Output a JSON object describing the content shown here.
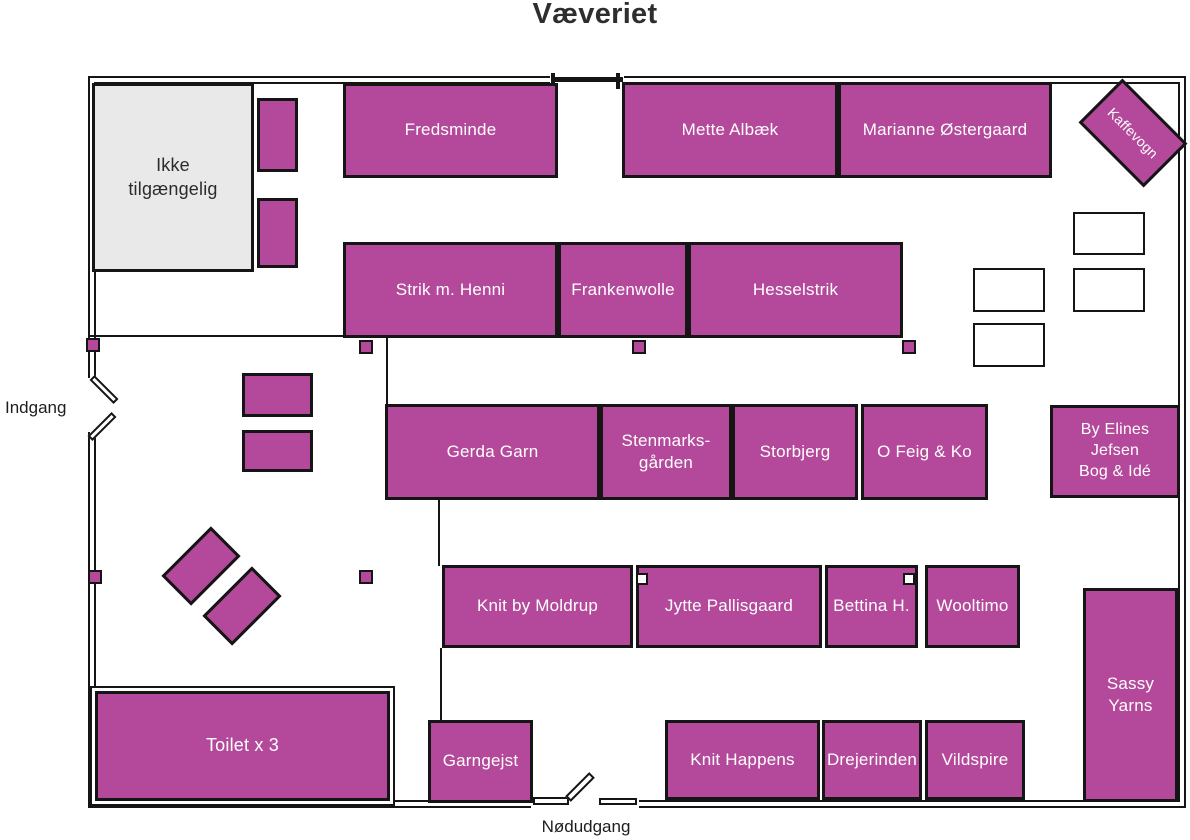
{
  "title": "Væveriet",
  "labels": {
    "entrance": "Indgang",
    "emergency_exit": "Nødudgang"
  },
  "colors": {
    "booth_fill": "#b4499b",
    "outline": "#151515",
    "unavailable_fill": "#e9e9e9",
    "booth_text": "#ffffff",
    "title_text": "#2e2e2e"
  },
  "floorplan": {
    "booths": [
      {
        "name": "ikke-tilgaengelig",
        "label": "Ikke\ntilgængelig",
        "type": "unavailable",
        "x": 92,
        "y": 83,
        "w": 162,
        "h": 189,
        "font": 18
      },
      {
        "name": "stand-top-1",
        "label": "",
        "x": 257,
        "y": 98,
        "w": 41,
        "h": 74
      },
      {
        "name": "stand-top-2",
        "label": "",
        "x": 257,
        "y": 198,
        "w": 41,
        "h": 70
      },
      {
        "name": "fredsminde",
        "label": "Fredsminde",
        "x": 343,
        "y": 83,
        "w": 215,
        "h": 95
      },
      {
        "name": "mette-albaek",
        "label": "Mette Albæk",
        "x": 622,
        "y": 82,
        "w": 216,
        "h": 96
      },
      {
        "name": "marianne-oestergaard",
        "label": "Marianne Østergaard",
        "x": 838,
        "y": 82,
        "w": 214,
        "h": 96
      },
      {
        "name": "kaffevogn",
        "label": "Kaffevogn",
        "x": 1087,
        "y": 102,
        "w": 92,
        "h": 62,
        "rotate": 45,
        "font": 14
      },
      {
        "name": "strik-m-henni",
        "label": "Strik m. Henni",
        "x": 343,
        "y": 242,
        "w": 215,
        "h": 96
      },
      {
        "name": "frankenwolle",
        "label": "Frankenwolle",
        "x": 558,
        "y": 242,
        "w": 130,
        "h": 96
      },
      {
        "name": "hesselstrik",
        "label": "Hesselstrik",
        "x": 688,
        "y": 242,
        "w": 215,
        "h": 96
      },
      {
        "name": "gerda-garn",
        "label": "Gerda Garn",
        "x": 385,
        "y": 404,
        "w": 215,
        "h": 96
      },
      {
        "name": "stenmarksgaarden",
        "label": "Stenmarks-\ngården",
        "x": 600,
        "y": 404,
        "w": 132,
        "h": 96
      },
      {
        "name": "storbjerg",
        "label": "Storbjerg",
        "x": 732,
        "y": 404,
        "w": 126,
        "h": 96
      },
      {
        "name": "o-feig-og-ko",
        "label": "O Feig & Ko",
        "x": 861,
        "y": 404,
        "w": 127,
        "h": 96
      },
      {
        "name": "by-elines-jefsen",
        "label": "By Elines\nJefsen\nBog & Idé",
        "x": 1050,
        "y": 405,
        "w": 130,
        "h": 93,
        "font": 16
      },
      {
        "name": "knit-by-moldrup",
        "label": "Knit by Moldrup",
        "x": 442,
        "y": 565,
        "w": 191,
        "h": 83
      },
      {
        "name": "jytte-pallisgaard",
        "label": "Jytte Pallisgaard",
        "x": 636,
        "y": 565,
        "w": 186,
        "h": 83
      },
      {
        "name": "bettina-h",
        "label": "Bettina H.",
        "x": 825,
        "y": 565,
        "w": 93,
        "h": 83
      },
      {
        "name": "wooltimo",
        "label": "Wooltimo",
        "x": 925,
        "y": 565,
        "w": 95,
        "h": 83
      },
      {
        "name": "sassy-yarns",
        "label": "Sassy\nYarns",
        "x": 1083,
        "y": 588,
        "w": 95,
        "h": 214
      },
      {
        "name": "toilet",
        "label": "Toilet x 3",
        "type": "toilet",
        "x": 95,
        "y": 691,
        "w": 295,
        "h": 110,
        "font": 18
      },
      {
        "name": "garngejst",
        "label": "Garngejst",
        "x": 428,
        "y": 720,
        "w": 105,
        "h": 83
      },
      {
        "name": "knit-happens",
        "label": "Knit Happens",
        "x": 665,
        "y": 720,
        "w": 155,
        "h": 80
      },
      {
        "name": "drejerinden",
        "label": "Drejerinden",
        "x": 822,
        "y": 720,
        "w": 100,
        "h": 80
      },
      {
        "name": "vildspire",
        "label": "Vildspire",
        "x": 925,
        "y": 720,
        "w": 100,
        "h": 80
      },
      {
        "name": "table-diagonal-1",
        "label": "",
        "x": 166,
        "y": 545,
        "w": 70,
        "h": 42,
        "rotate": -45
      },
      {
        "name": "table-diagonal-2",
        "label": "",
        "x": 207,
        "y": 585,
        "w": 70,
        "h": 42,
        "rotate": -45
      },
      {
        "name": "stand-left-1",
        "label": "",
        "x": 242,
        "y": 373,
        "w": 71,
        "h": 44
      },
      {
        "name": "stand-left-2",
        "label": "",
        "x": 242,
        "y": 430,
        "w": 71,
        "h": 42
      }
    ],
    "storage_boxes": [
      {
        "x": 1073,
        "y": 212,
        "w": 72,
        "h": 43
      },
      {
        "x": 973,
        "y": 268,
        "w": 72,
        "h": 44
      },
      {
        "x": 1073,
        "y": 268,
        "w": 72,
        "h": 44
      },
      {
        "x": 973,
        "y": 323,
        "w": 72,
        "h": 44
      }
    ],
    "pillars": [
      {
        "x": 86,
        "y": 338,
        "style": "filled"
      },
      {
        "x": 359,
        "y": 340,
        "style": "filled"
      },
      {
        "x": 632,
        "y": 340,
        "style": "filled"
      },
      {
        "x": 902,
        "y": 340,
        "style": "filled"
      },
      {
        "x": 88,
        "y": 570,
        "style": "filled"
      },
      {
        "x": 359,
        "y": 570,
        "style": "filled"
      },
      {
        "x": 636,
        "y": 573,
        "style": "hollow"
      },
      {
        "x": 903,
        "y": 573,
        "style": "hollow"
      }
    ]
  }
}
